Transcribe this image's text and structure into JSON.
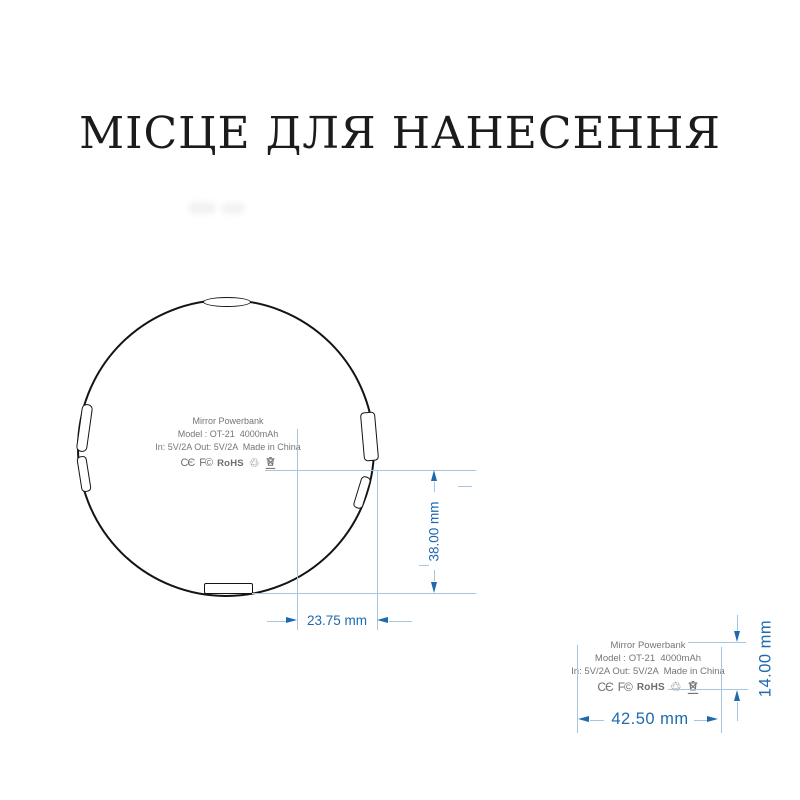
{
  "title": "МІСЦЕ ДЛЯ НАНЕСЕННЯ",
  "device_label": {
    "line1": "Mirror Powerbank",
    "line2": "Model : OT-21  4000mAh",
    "line3": "In: 5V/2A Out: 5V/2A  Made in China",
    "certifications": {
      "ce": "CЄ",
      "fcc": "F©",
      "rohs": "RoHS",
      "recycle": "♲"
    }
  },
  "dimensions": {
    "top_view": {
      "width": "23.75 mm",
      "height": "38.00 mm"
    },
    "side_view": {
      "width": "42.50 mm",
      "height": "14.00 mm"
    }
  },
  "colors": {
    "dimension_primary": "#1d6ab0",
    "dimension_light": "#a6c5e0",
    "label_text": "#757575",
    "outline": "#141414"
  }
}
